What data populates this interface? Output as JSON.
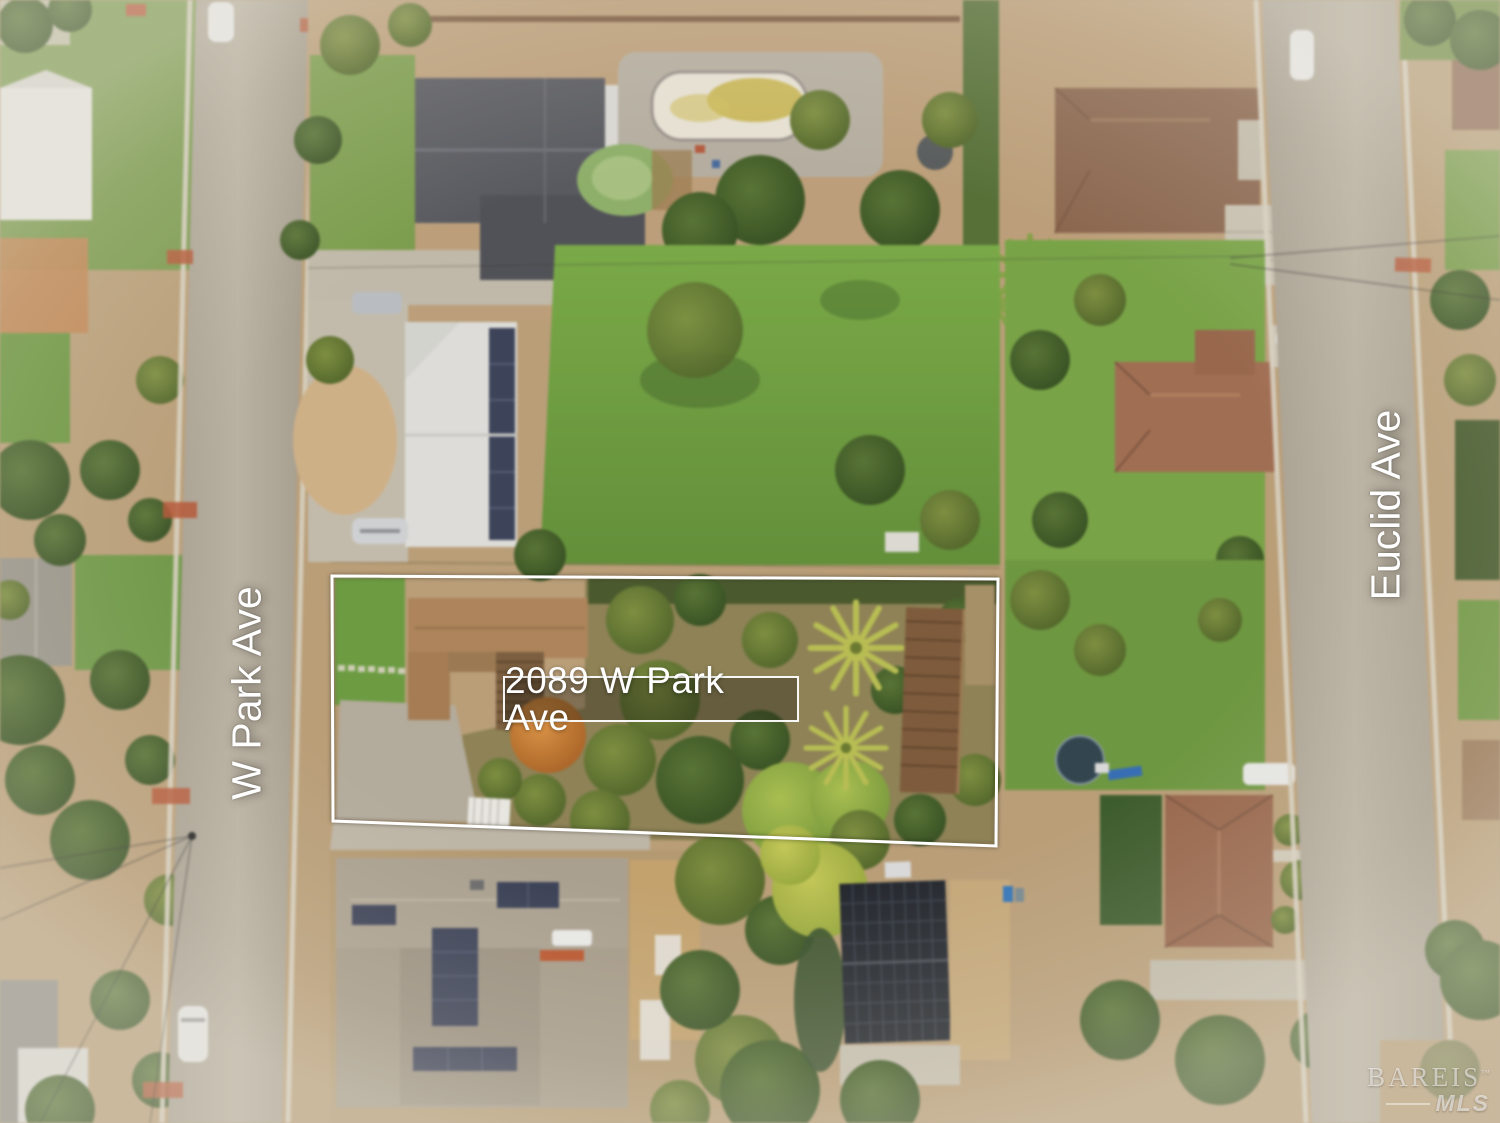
{
  "overlay": {
    "property_label": "2089 W Park Ave",
    "street_left_label": "W Park Ave",
    "street_right_label": "Euclid Ave"
  },
  "watermark": {
    "brand": "BAREIS",
    "trademark": "™",
    "suffix": "MLS"
  },
  "colors": {
    "boundary_stroke": "#ffffff",
    "label_text": "#ffffff",
    "label_border": "#ffffff",
    "label_background": "rgba(20,22,14,0.35)",
    "street_label_text": "#ffffff",
    "watermark_text": "rgba(255,255,255,0.55)"
  }
}
